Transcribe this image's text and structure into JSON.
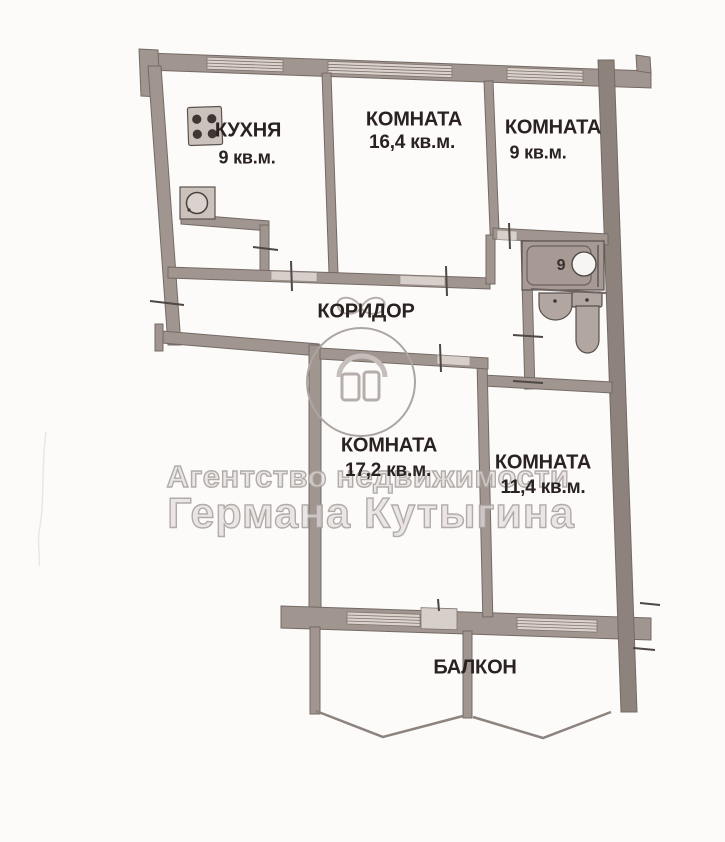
{
  "plan": {
    "rooms": [
      {
        "name": "КУХНЯ",
        "area": "9 кв.м."
      },
      {
        "name": "КОМНАТА",
        "area": "16,4 кв.м."
      },
      {
        "name": "КОМНАТА",
        "area": "9 кв.м."
      },
      {
        "name": "КОРИДОР",
        "area": ""
      },
      {
        "name": "КОМНАТА",
        "area": "17,2 кв.м."
      },
      {
        "name": "КОМНАТА",
        "area": "11,4 кв.м."
      },
      {
        "name": "БАЛКОН",
        "area": ""
      }
    ],
    "bathroom_digit": "9"
  },
  "watermark": {
    "line1": "Агентство недвижимости",
    "line2": "Германа Кутыгина"
  },
  "colors": {
    "wall": "#a1958f",
    "wall_dark_edge": "#746a65",
    "wall_right": "#8d827c",
    "window_fill": "#dad2cb",
    "door_fill": "#d7cfc9",
    "fixture_fill": "#b2a6a0",
    "label_text": "#2a2220",
    "watermark_gray": "#a8a19e",
    "background": "#fcfbfa"
  }
}
